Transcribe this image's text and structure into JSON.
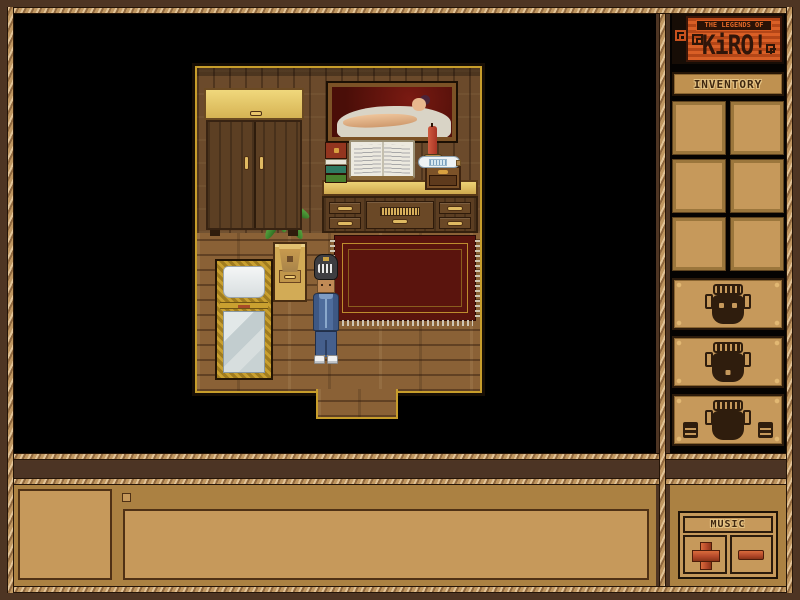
{
  "window": {
    "width": 800,
    "height": 600
  },
  "logo": {
    "tagline": "THE LEGENDS OF",
    "title": "KiRO!",
    "accent_orange": "#c8521e"
  },
  "sidebar": {
    "inventory_label": "INVENTORY",
    "slot_count": 6,
    "mask_buttons": [
      {
        "id": 1,
        "icon": "tiki-mask-eyes-open"
      },
      {
        "id": 2,
        "icon": "tiki-mask-sleeping"
      },
      {
        "id": 3,
        "icon": "tiki-mask-with-fists"
      }
    ],
    "music": {
      "label": "MUSIC",
      "volume_up_icon": "plus-cross",
      "volume_down_icon": "minus-bar",
      "button_red": "#b5492a"
    }
  },
  "message_panel": {
    "portrait_empty": true,
    "text_empty": true
  },
  "scene": {
    "room_objects": [
      "wardrobe",
      "wall-painting-reclining-figure",
      "desk-dresser",
      "open-book",
      "book-stack",
      "candle",
      "message-bottle",
      "mini-chest",
      "potted-plant",
      "nightstand",
      "bed",
      "red-rug",
      "doorway"
    ],
    "player": {
      "headgear": "striped-helmet",
      "outfit": "blue-denim-jacket-and-pants",
      "shoes": "white-sneakers"
    }
  },
  "colors": {
    "frame_brown": "#4e3523",
    "rope_tan": "#bf9660",
    "panel_tan": "#c6995b",
    "panel_brown": "#ab8142",
    "slot_border": "#9b763c",
    "mask_dark": "#2f1d0d",
    "rug_red": "#5a140d",
    "room_border_gold": "#c79d2b"
  }
}
